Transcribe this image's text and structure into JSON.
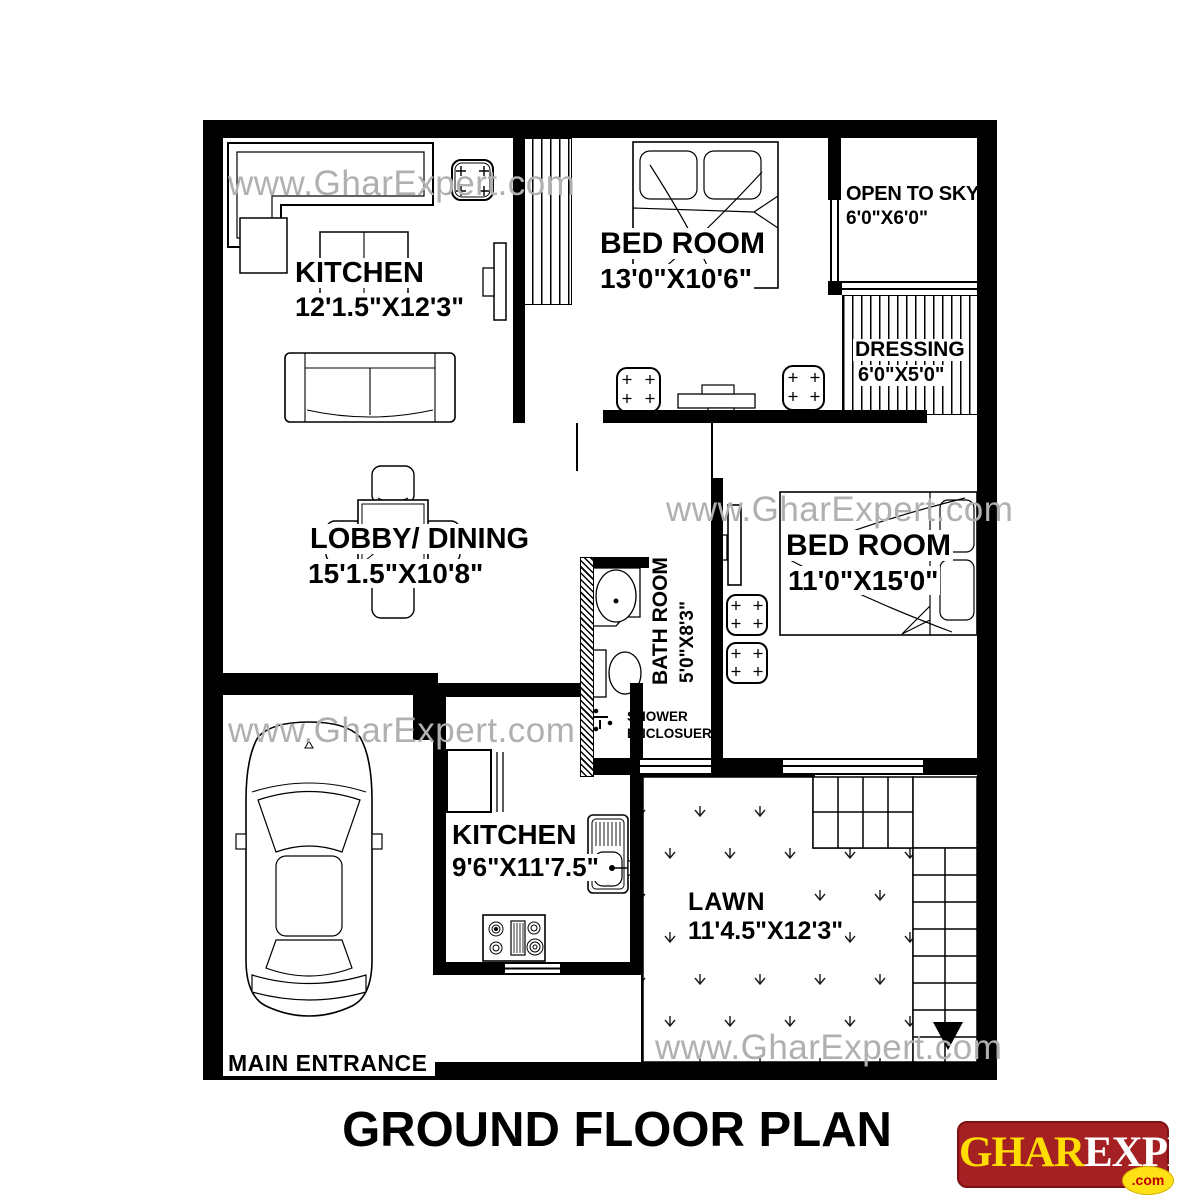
{
  "watermark": "www.GharExpert.com",
  "title": "GROUND FLOOR PLAN",
  "rooms": {
    "kitchen_top": {
      "name": "KITCHEN",
      "dims": "12'1.5\"X12'3\""
    },
    "bedroom_top": {
      "name": "BED ROOM",
      "dims": "13'0\"X10'6\""
    },
    "open_to_sky": {
      "name": "OPEN TO SKY",
      "dims": "6'0\"X6'0\""
    },
    "dressing": {
      "name": "DRESSING",
      "dims": "6'0\"X5'0\""
    },
    "lobby_dining": {
      "name": "LOBBY/ DINING",
      "dims": "15'1.5\"X10'8\""
    },
    "bedroom_right": {
      "name": "BED ROOM",
      "dims": "11'0\"X15'0\""
    },
    "bathroom": {
      "name": "BATH ROOM",
      "dims": "5'0\"X8'3\""
    },
    "shower": {
      "line1": "SHOWER",
      "line2": "ENCLOSUERS"
    },
    "kitchen_bottom": {
      "name": "KITCHEN",
      "dims": "9'6\"X11'7.5\""
    },
    "lawn": {
      "name": "LAWN",
      "dims": "11'4.5\"X12'3\""
    },
    "entrance": {
      "label": "MAIN ENTRANCE"
    }
  },
  "logo": {
    "ghar": "GHAR",
    "expert": "EXPERT",
    "tld": ".com"
  },
  "colors": {
    "wall": "#000000",
    "watermark_gray": "#b0b0b0",
    "logo_red": "#a42023",
    "logo_yellow": "#ffdd00",
    "logo_com_red": "#c00000"
  }
}
